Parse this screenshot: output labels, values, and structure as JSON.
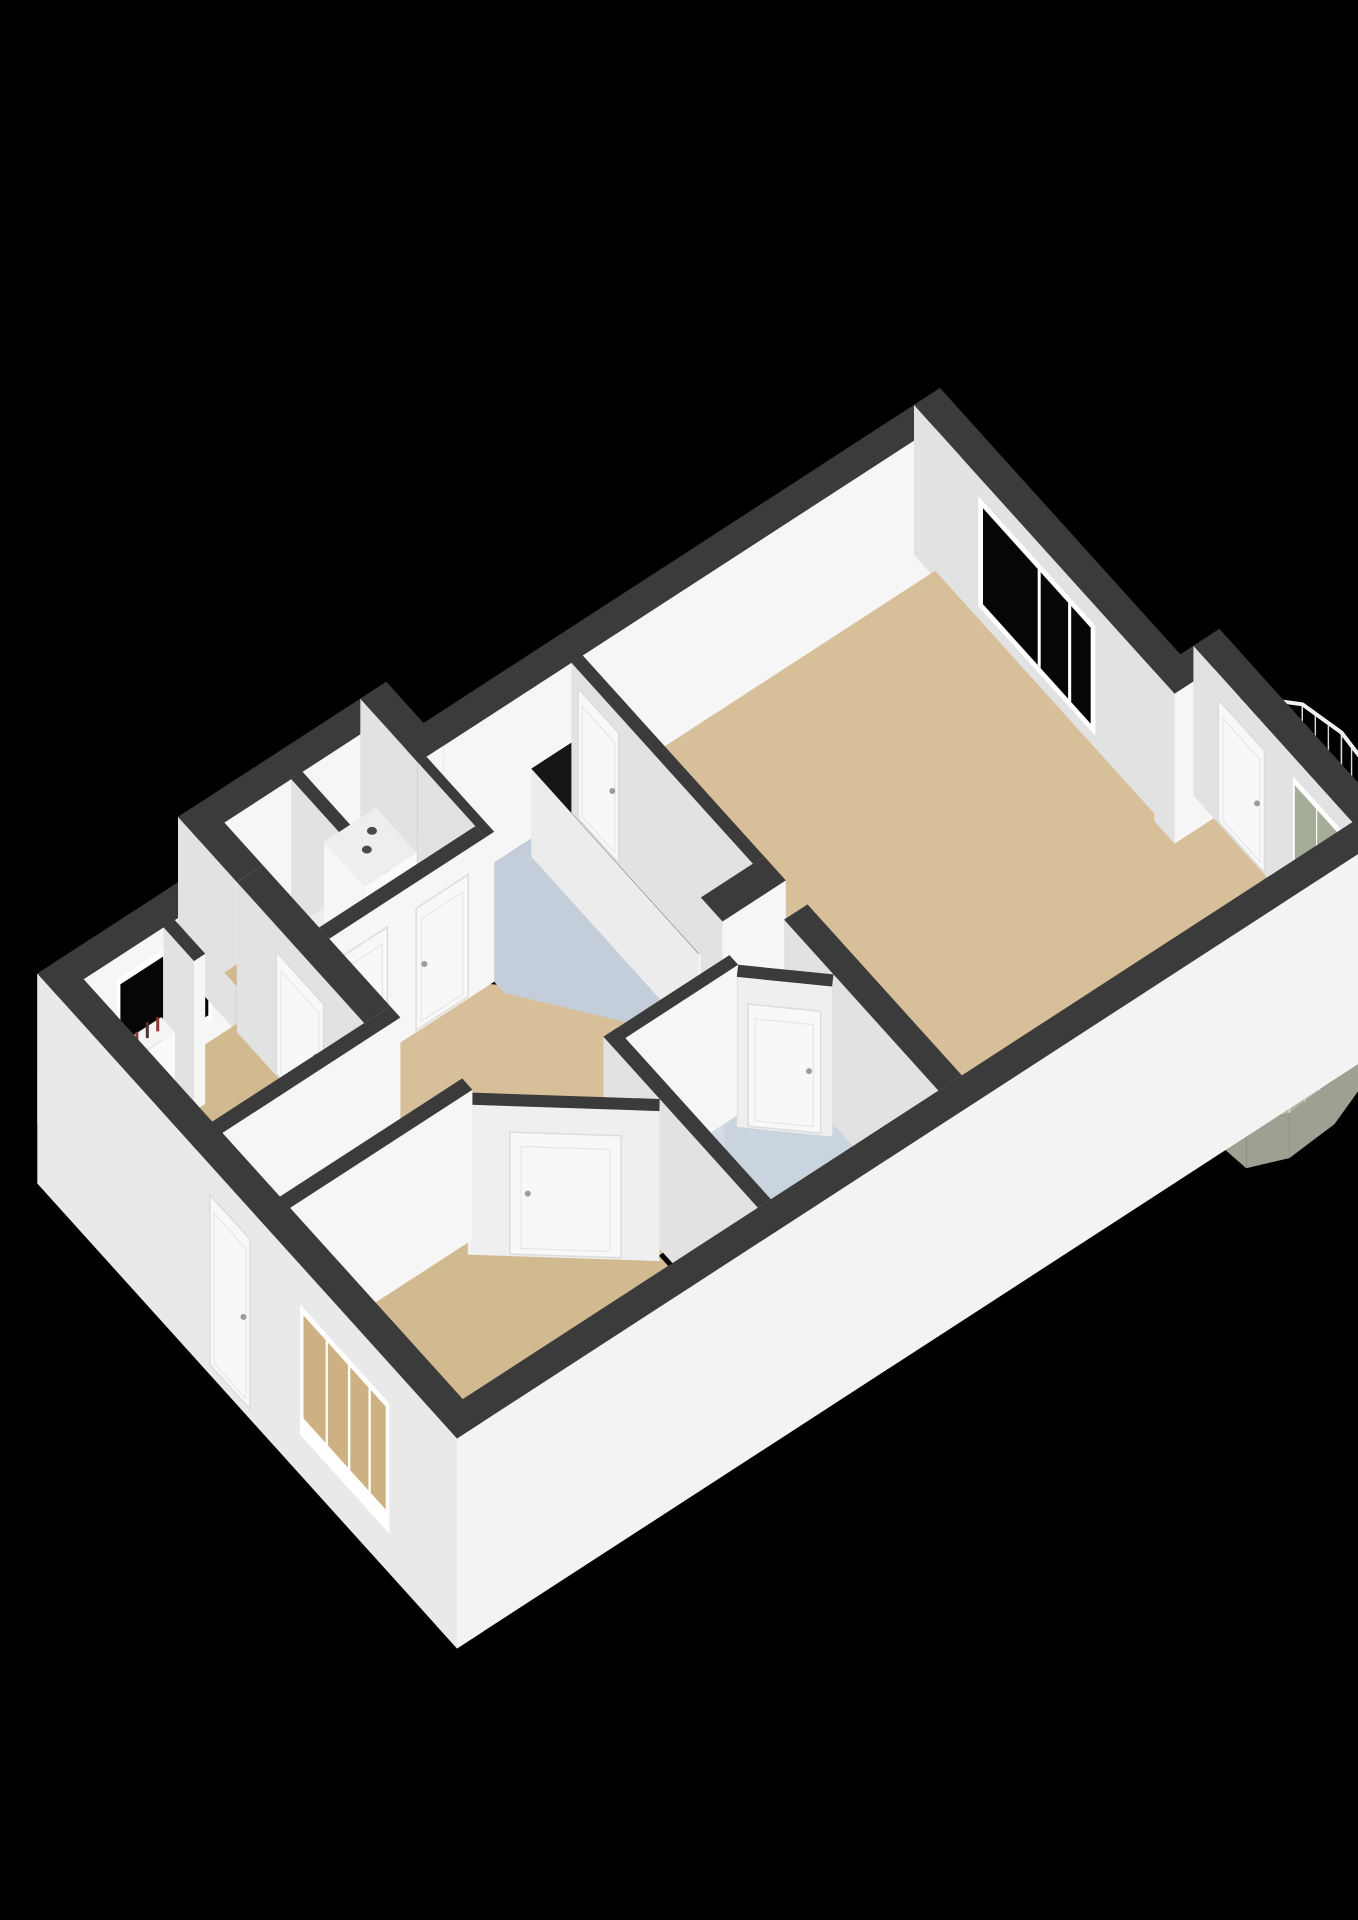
{
  "meta": {
    "type": "3d-floorplan-render",
    "description_semantic": "isometric-apartment-floorplan",
    "rooms": [
      "living-room",
      "kitchen",
      "hallway",
      "bathroom",
      "bedroom-bottom",
      "bedroom-left",
      "washer-closet",
      "toilet",
      "balcony"
    ]
  },
  "canvas": {
    "width": 1358,
    "height": 1920,
    "background": "#000000"
  },
  "palette": {
    "wallTop": "#3b3b3b",
    "faceSE": "#f6f6f6",
    "faceSW": "#e2e2e2",
    "faceDiag": "#efefef",
    "extSE": "#f3f3f3",
    "extSW": "#e9e9e9",
    "floorTan": "#d7bf99",
    "floorTanDark": "#d2ba90",
    "floorKitchen": "#c4cedb",
    "floorBath": "#cad4de",
    "floorCloset": "#ededed",
    "floorBalcony": "#b5b6a5",
    "balconySkirt": "#9fa091",
    "counterTop": "#161616",
    "stove": "#0e0e0e",
    "burner": "#d8311c",
    "burnerCore": "#4a120c",
    "sinkOuter": "#d9dde0",
    "sinkInner": "#a8aeb4",
    "steel": "#b9bec3",
    "door": "#f8f8f8",
    "doorLine": "#dcdcdc",
    "handle": "#9c9c9c",
    "frame": "#ffffff",
    "glassDark": "#060606",
    "glassBalcony": "#a4ad98",
    "glassBedroom": "#cdb183",
    "railTop": "#f0f0f0",
    "railBar": "#d9d9d9",
    "washer": "#f6f6f6",
    "washerTop": "#eeeeee",
    "washerDot": "#4a4a4a",
    "pipe": "#8a3a2e",
    "showerGlassEdge": "#e6ecf0"
  },
  "projection": {
    "origin": [
      940,
      388
    ],
    "eP": [
      -86.8,
      56.3
    ],
    "eQ": [
      67.7,
      75.0
    ],
    "wall_h": 150,
    "skirt_h": 210,
    "floor_dz": 150
  },
  "walls_back": [
    {
      "name": "wall-nw-main-a",
      "type": "rect",
      "p0": 0,
      "p1": 5.95,
      "q0": 0,
      "q1": 0.3
    },
    {
      "name": "wall-wing-nw",
      "type": "rect",
      "p0": 5.95,
      "p1": 8.35,
      "q0": -0.55,
      "q1": -0.25
    },
    {
      "name": "wall-wing-ne",
      "type": "rect",
      "p0": 5.95,
      "p1": 6.25,
      "q0": -0.55,
      "q1": 0.3
    },
    {
      "name": "wall-nw-main-b",
      "type": "rect",
      "p0": 8.35,
      "p1": 10.4,
      "q0": 0,
      "q1": 0.3,
      "decals": [
        {
          "kind": "window",
          "name": "bedroom-left-window",
          "face": "SE",
          "t0": 8.62,
          "t1": 9.72,
          "dz0": 22,
          "dz1": 124,
          "glass": "#060606",
          "mullions": [
            0.5
          ]
        }
      ]
    },
    {
      "name": "wall-wing-sw",
      "type": "rect",
      "p0": 8.05,
      "p1": 8.35,
      "q0": -0.55,
      "q1": 0.32
    },
    {
      "name": "wall-closet-divider",
      "type": "rect",
      "p0": 7.15,
      "p1": 7.28,
      "q0": -0.25,
      "q1": 1.15
    },
    {
      "name": "wall-ne-main",
      "type": "rect",
      "p0": 0,
      "p1": 0.3,
      "q0": 0,
      "q1": 3.85,
      "decals": [
        {
          "kind": "window",
          "name": "living-room-window",
          "face": "SW",
          "t0": 0.95,
          "t1": 2.68,
          "dz0": 20,
          "dz1": 130,
          "glass": "#060606",
          "mullions": [
            0.52,
            0.78
          ]
        }
      ]
    }
  ],
  "balcony": {
    "name": "balcony",
    "plate": [
      [
        -0.15,
        3.95
      ],
      [
        -0.55,
        4.02
      ],
      [
        -0.82,
        4.3
      ],
      [
        -0.92,
        4.75
      ],
      [
        -0.88,
        5.25
      ],
      [
        -0.68,
        5.7
      ],
      [
        -0.35,
        6.1
      ],
      [
        0.1,
        6.45
      ],
      [
        0.65,
        6.66
      ],
      [
        1.2,
        6.7
      ],
      [
        1.58,
        6.55
      ],
      [
        1.62,
        6.22
      ],
      [
        1.55,
        6.2
      ],
      [
        -0.15,
        6.2
      ]
    ],
    "rail_end_index": 11,
    "plate_dz": 155,
    "skirt_dz": 200,
    "rail_top_dz": 40,
    "bar_step": 0.17
  },
  "floors": [
    {
      "name": "floor-hallway",
      "color": "#d7bf99",
      "pts": [
        [
          4.35,
          3.0
        ],
        [
          6.3,
          1.2
        ],
        [
          8.4,
          1.2
        ],
        [
          8.4,
          2.3
        ],
        [
          10.25,
          2.3
        ],
        [
          10.25,
          3.3
        ],
        [
          8.1,
          3.32
        ],
        [
          6.75,
          4.5
        ],
        [
          6.5,
          4.5
        ],
        [
          6.5,
          3.6
        ],
        [
          4.35,
          3.66
        ]
      ]
    },
    {
      "name": "floor-kitchen",
      "color": "#c4cedb",
      "pts": [
        [
          4.48,
          0.3
        ],
        [
          6.15,
          0.3
        ],
        [
          6.15,
          1.45
        ],
        [
          4.98,
          2.98
        ],
        [
          4.48,
          2.98
        ]
      ]
    },
    {
      "name": "floor-washer-closet",
      "color": "#ededed",
      "pts": [
        [
          6.25,
          -0.25
        ],
        [
          7.15,
          -0.25
        ],
        [
          7.15,
          1.2
        ],
        [
          6.25,
          1.2
        ]
      ]
    },
    {
      "name": "floor-toilet",
      "color": "#d2ba90",
      "pts": [
        [
          7.28,
          -0.25
        ],
        [
          8.05,
          -0.25
        ],
        [
          8.05,
          1.2
        ],
        [
          7.28,
          1.2
        ]
      ]
    },
    {
      "name": "floor-bathroom",
      "color": "#cad4de",
      "pts": [
        [
          5.2,
          3.68
        ],
        [
          6.62,
          3.68
        ],
        [
          6.62,
          5.95
        ],
        [
          4.55,
          5.95
        ],
        [
          4.55,
          4.4
        ]
      ]
    },
    {
      "name": "floor-bedroom-left",
      "color": "#d2ba90",
      "pts": [
        [
          8.2,
          0.25
        ],
        [
          10.25,
          0.25
        ],
        [
          10.25,
          2.3
        ],
        [
          8.2,
          2.3
        ]
      ]
    },
    {
      "name": "floor-bedroom-bottom",
      "color": "#d2ba90",
      "pts": [
        [
          6.75,
          4.4
        ],
        [
          8.1,
          3.3
        ],
        [
          10.25,
          3.3
        ],
        [
          10.25,
          5.95
        ],
        [
          6.75,
          5.95
        ]
      ]
    },
    {
      "name": "floor-living-room",
      "color": "#d7bf99",
      "pts": [
        [
          0.25,
          0.25
        ],
        [
          4.45,
          0.25
        ],
        [
          4.45,
          5.95
        ],
        [
          -0.2,
          5.95
        ],
        [
          -0.2,
          3.7
        ],
        [
          0.25,
          3.7
        ]
      ]
    }
  ],
  "walls_mid": [
    {
      "name": "wall-bay-jog",
      "type": "rect",
      "p0": -0.45,
      "p1": 0.3,
      "q0": 3.55,
      "q1": 3.85
    },
    {
      "name": "wall-bay-ne",
      "type": "rect",
      "p0": -0.45,
      "p1": -0.15,
      "q0": 3.55,
      "q1": 6.2,
      "decals": [
        {
          "kind": "door",
          "name": "balcony-door",
          "face": "SW",
          "t0": 3.92,
          "t1": 4.6
        },
        {
          "kind": "window",
          "name": "balcony-window",
          "face": "SW",
          "t0": 5.02,
          "t1": 5.72,
          "dz0": 20,
          "dz1": 108,
          "glass": "#a4ad98",
          "mullions": [
            0.5
          ],
          "sill": true
        }
      ]
    },
    {
      "name": "wall-radiator-stub",
      "type": "rect",
      "p0": 9.05,
      "p1": 9.18,
      "q0": 0.3,
      "q1": 0.75
    }
  ],
  "fixtures": [
    {
      "kind": "prism",
      "name": "kitchen-counter",
      "p0": 4.48,
      "p1": 5.06,
      "q0": 0.45,
      "q1": 2.92,
      "top": 62,
      "topFill": "#161616",
      "swFill": "#ececec",
      "seFill": "#f5f5f5",
      "details": [
        {
          "shape": "rect",
          "name": "sink-outer",
          "p0": 4.6,
          "p1": 4.96,
          "q0": 1.06,
          "q1": 1.5,
          "fill": "#d9dde0"
        },
        {
          "shape": "rect",
          "name": "sink-basin",
          "p0": 4.66,
          "p1": 4.9,
          "q0": 1.13,
          "q1": 1.43,
          "fill": "#a8aeb4"
        },
        {
          "shape": "faucet",
          "name": "kitchen-faucet",
          "at": [
            4.92,
            1.27
          ],
          "fill": "#b9bec3"
        },
        {
          "shape": "rect",
          "name": "stove",
          "p0": 4.56,
          "p1": 5.0,
          "q0": 2.1,
          "q1": 2.64,
          "fill": "#0e0e0e"
        },
        {
          "shape": "circle",
          "name": "burner-1",
          "at": [
            4.71,
            2.26
          ],
          "r": 8,
          "fill": "#d8311c",
          "core": "#4a120c"
        },
        {
          "shape": "circle",
          "name": "burner-2",
          "at": [
            4.87,
            2.49
          ],
          "r": 6,
          "fill": "#d8311c",
          "core": "#4a120c"
        }
      ]
    },
    {
      "kind": "prism",
      "name": "washer-boiler",
      "p0": 6.38,
      "p1": 6.98,
      "q0": -0.15,
      "q1": 0.45,
      "top": 72,
      "topFill": "#eeeeee",
      "swFill": "#f6f6f6",
      "seFill": "#fbfbfb",
      "details": [
        {
          "shape": "circle",
          "name": "boiler-opening-1",
          "at": [
            6.56,
            0.02
          ],
          "r": 5,
          "fill": "#4a4a4a"
        },
        {
          "shape": "circle",
          "name": "boiler-opening-2",
          "at": [
            6.72,
            0.15
          ],
          "r": 5,
          "fill": "#4a4a4a"
        }
      ]
    },
    {
      "kind": "prism",
      "name": "window-sill-ledge",
      "p0": 0.02,
      "p1": 0.62,
      "q0": 5.62,
      "q1": 5.9,
      "top": 92,
      "topFill": "#f2f2f2",
      "swFill": "#e8e8e8",
      "seFill": "#f6f6f6",
      "details": []
    },
    {
      "kind": "prism",
      "name": "radiator",
      "p0": 9.22,
      "p1": 9.74,
      "q0": 0.32,
      "q1": 0.52,
      "top": 86,
      "topFill": "#f4f4f4",
      "swFill": "#ededed",
      "seFill": "#fafafa",
      "details": [
        {
          "shape": "pipe",
          "name": "radiator-pipe-1",
          "at": [
            9.34,
            0.42
          ],
          "len": 14,
          "stroke": "#8a3a2e"
        },
        {
          "shape": "pipe",
          "name": "radiator-pipe-2",
          "at": [
            9.46,
            0.42
          ],
          "len": 16,
          "stroke": "#54302a"
        },
        {
          "shape": "pipe",
          "name": "radiator-pipe-3",
          "at": [
            9.58,
            0.42
          ],
          "len": 13,
          "stroke": "#8a3a2e"
        }
      ]
    },
    {
      "kind": "shower",
      "name": "shower-enclosure",
      "center": [
        6.62,
        3.68
      ],
      "r": 1.0,
      "segments": 9,
      "glass_top_dz": 36,
      "panel_fill": "rgba(214,224,232,0.45)",
      "edge": "#e6ecf0",
      "head_at": [
        6.45,
        3.86
      ],
      "drain_at": [
        6.3,
        4.0
      ]
    }
  ],
  "walls_front": [
    {
      "name": "wall-kitchen-closet",
      "type": "rect",
      "p0": 6.15,
      "p1": 6.25,
      "q0": 0.3,
      "q1": 1.3
    },
    {
      "name": "wall-living-kitchen",
      "type": "rect",
      "p0": 4.35,
      "p1": 4.48,
      "q0": 0.3,
      "q1": 2.98,
      "decals": [
        {
          "kind": "door",
          "name": "kitchen-tall-cabinet",
          "face": "SW",
          "t0": 0.4,
          "t1": 1.0,
          "dz0": 18,
          "dz1": 148
        }
      ]
    },
    {
      "name": "wall-kitchen-end-block",
      "type": "rect",
      "p0": 4.35,
      "p1": 5.08,
      "q0": 2.98,
      "q1": 3.3
    },
    {
      "name": "wall-closets-se",
      "type": "rect",
      "p0": 6.25,
      "p1": 8.05,
      "q0": 1.15,
      "q1": 1.3,
      "decals": [
        {
          "kind": "door",
          "name": "washer-closet-door",
          "face": "SE",
          "t0": 6.45,
          "t1": 7.05
        },
        {
          "kind": "door",
          "name": "toilet-door",
          "face": "SE",
          "t0": 7.38,
          "t1": 7.98
        }
      ]
    },
    {
      "name": "wall-bedroom-left-ne",
      "type": "rect",
      "p0": 8.05,
      "p1": 8.35,
      "q0": 0.32,
      "q1": 2.2,
      "decals": [
        {
          "kind": "door",
          "name": "bedroom-left-door",
          "face": "SW",
          "t0": 0.9,
          "t1": 1.6
        }
      ]
    },
    {
      "name": "wall-bedrooms-divider",
      "type": "rect",
      "p0": 8.05,
      "p1": 10.4,
      "q0": 2.2,
      "q1": 2.35
    },
    {
      "name": "wall-living-bathroom",
      "type": "rect",
      "p0": 4.35,
      "p1": 4.62,
      "q0": 3.62,
      "q1": 5.9
    },
    {
      "name": "wall-bathroom-nw",
      "type": "rect",
      "p0": 5.25,
      "p1": 6.7,
      "q0": 3.62,
      "q1": 3.75
    },
    {
      "name": "wall-bathroom-chamfer",
      "type": "diag",
      "a": [
        5.25,
        3.75
      ],
      "b": [
        4.62,
        4.35
      ],
      "th": 0.13,
      "decals": [
        {
          "kind": "door",
          "name": "bathroom-door",
          "face": "D",
          "t0": 0.12,
          "t1": 0.88
        }
      ]
    },
    {
      "name": "wall-bathroom-sw",
      "type": "rect",
      "p0": 6.55,
      "p1": 6.7,
      "q0": 3.62,
      "q1": 5.9
    },
    {
      "name": "wall-bedroom-bottom-chamfer",
      "type": "diag",
      "a": [
        6.7,
        4.45
      ],
      "b": [
        8.05,
        3.35
      ],
      "th": 0.13,
      "decals": [
        {
          "kind": "door",
          "name": "bedroom-bottom-door",
          "face": "D",
          "t0": 0.2,
          "t1": 0.78
        }
      ]
    },
    {
      "name": "wall-bedroom-bottom-nw",
      "type": "rect",
      "p0": 8.0,
      "p1": 10.4,
      "q0": 3.2,
      "q1": 3.35
    },
    {
      "name": "wall-se-exterior",
      "type": "rect",
      "p0": -0.45,
      "p1": 10.4,
      "q0": 5.9,
      "q1": 6.2,
      "skirt": true
    },
    {
      "name": "wall-sw-exterior",
      "type": "rect",
      "p0": 10.1,
      "p1": 10.4,
      "q0": 0,
      "q1": 6.2,
      "skirt": true,
      "decals": [
        {
          "kind": "door",
          "name": "entry-door",
          "face": "SW",
          "t0": 2.55,
          "t1": 3.14,
          "dz0": 30,
          "dz1": 200
        },
        {
          "kind": "window",
          "name": "bedroom-bottom-window",
          "face": "SW",
          "t0": 3.88,
          "t1": 5.2,
          "dz0": 40,
          "dz1": 170,
          "glass": "#cdb183",
          "mullions": [
            0.3,
            0.55,
            0.78
          ],
          "sill": true
        }
      ]
    }
  ]
}
